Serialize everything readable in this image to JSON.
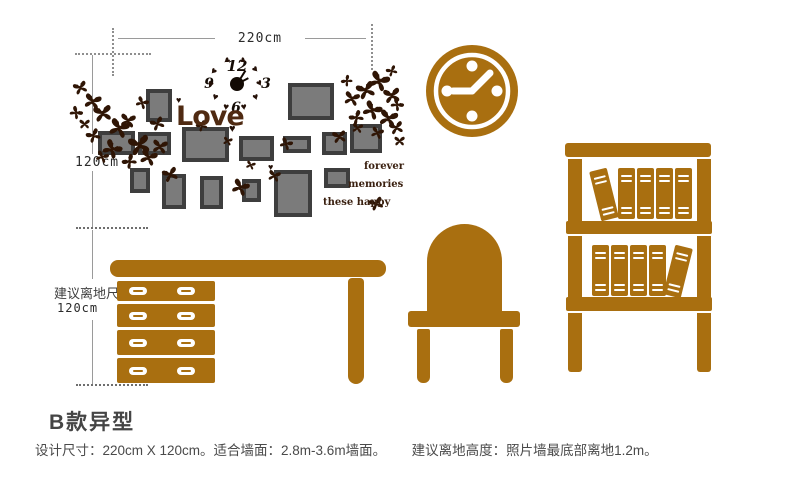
{
  "colors": {
    "brown": "#a96f10",
    "dark_brown": "#2f1505",
    "love_brown": "#4f2a12",
    "frame_border": "#3e3e3e",
    "frame_fill": "#7b7b7b",
    "dim_line": "#9a9a9a",
    "text_dark": "#454545"
  },
  "dimensions": {
    "top_width_label": "220cm",
    "left_height_label": "120cm",
    "floor_offset_title": "建议离地尺寸",
    "floor_offset_value": "120cm"
  },
  "photo_wall": {
    "love_text": "Love",
    "words": [
      "forever",
      "memories",
      "these happy"
    ],
    "clock_numbers": {
      "twelve": "12",
      "three": "3",
      "six": "6",
      "nine": "9"
    }
  },
  "icons": {
    "butterfly": "butterfly-icon",
    "heart": "heart-icon",
    "wall_clock": "wall-clock-icon",
    "desk": "desk-icon",
    "chair": "chair-icon",
    "bookshelf": "bookshelf-icon"
  },
  "footer": {
    "style_title": "B款异型",
    "spec_line_1": "设计尺寸：220cm X 120cm。适合墙面：2.8m-3.6m墙面。",
    "spec_line_2": "建议离地高度：照片墙最底部离地1.2m。"
  }
}
